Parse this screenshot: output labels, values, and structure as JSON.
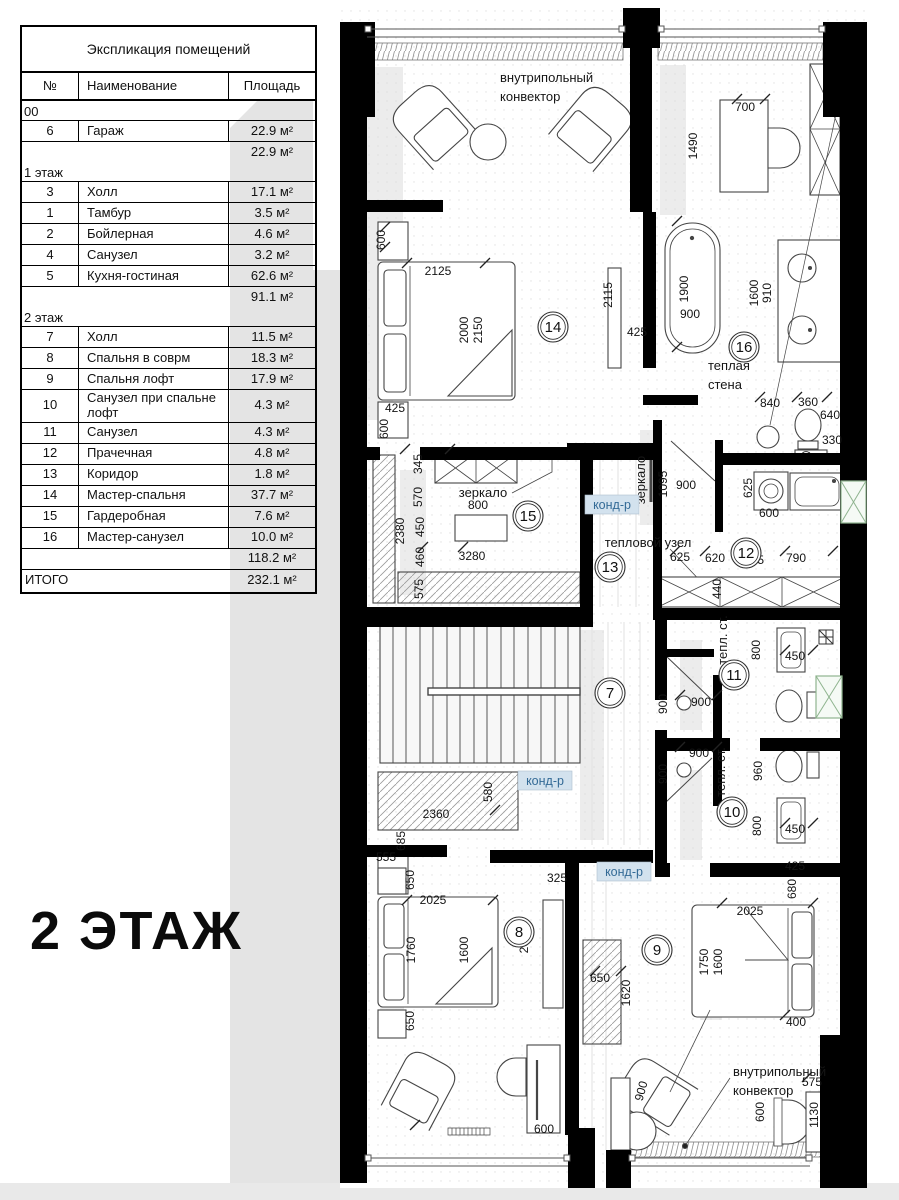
{
  "floor_title": "2 ЭТАЖ",
  "legend": {
    "title": "Экспликация помещений",
    "columns": [
      "№",
      "Наименование",
      "Площадь"
    ],
    "sections": [
      {
        "label": "00",
        "rows": [
          {
            "n": "6",
            "name": "Гараж",
            "area": "22.9 м²"
          }
        ],
        "subtotal": "22.9 м²"
      },
      {
        "label": "1 этаж",
        "rows": [
          {
            "n": "3",
            "name": "Холл",
            "area": "17.1 м²"
          },
          {
            "n": "1",
            "name": "Тамбур",
            "area": "3.5 м²"
          },
          {
            "n": "2",
            "name": "Бойлерная",
            "area": "4.6 м²"
          },
          {
            "n": "4",
            "name": "Санузел",
            "area": "3.2 м²"
          },
          {
            "n": "5",
            "name": "Кухня-гостиная",
            "area": "62.6 м²"
          }
        ],
        "subtotal": "91.1 м²"
      },
      {
        "label": "2 этаж",
        "rows": [
          {
            "n": "7",
            "name": "Холл",
            "area": "11.5 м²"
          },
          {
            "n": "8",
            "name": "Спальня в соврм",
            "area": "18.3 м²"
          },
          {
            "n": "9",
            "name": "Спальня лофт",
            "area": "17.9 м²"
          },
          {
            "n": "10",
            "name": "Санузел при спальне лофт",
            "area": "4.3 м²"
          },
          {
            "n": "11",
            "name": "Санузел",
            "area": "4.3 м²"
          },
          {
            "n": "12",
            "name": "Прачечная",
            "area": "4.8 м²"
          },
          {
            "n": "13",
            "name": "Коридор",
            "area": "1.8 м²"
          },
          {
            "n": "14",
            "name": "Мастер-спальня",
            "area": "37.7 м²"
          },
          {
            "n": "15",
            "name": "Гардеробная",
            "area": "7.6 м²"
          },
          {
            "n": "16",
            "name": "Мастер-санузел",
            "area": "10.0 м²"
          }
        ],
        "subtotal": "118.2 м²"
      }
    ],
    "total_label": "ИТОГО",
    "total": "232.1 м²"
  },
  "plan": {
    "rooms": [
      {
        "n": "14",
        "x": 213,
        "y": 327
      },
      {
        "n": "16",
        "x": 404,
        "y": 347
      },
      {
        "n": "15",
        "x": 188,
        "y": 516
      },
      {
        "n": "13",
        "x": 270,
        "y": 567
      },
      {
        "n": "12",
        "x": 406,
        "y": 553
      },
      {
        "n": "7",
        "x": 270,
        "y": 693
      },
      {
        "n": "11",
        "x": 394,
        "y": 675
      },
      {
        "n": "10",
        "x": 392,
        "y": 812
      },
      {
        "n": "8",
        "x": 179,
        "y": 932
      },
      {
        "n": "9",
        "x": 317,
        "y": 950
      }
    ],
    "tags": [
      {
        "t": "конд-р",
        "x": 272,
        "y": 505
      },
      {
        "t": "конд-р",
        "x": 205,
        "y": 781
      },
      {
        "t": "конд-р",
        "x": 284,
        "y": 872
      }
    ],
    "labels": [
      {
        "t": "внутрипольный",
        "x": 160,
        "y": 82,
        "a": "start"
      },
      {
        "t": "конвектор",
        "x": 160,
        "y": 101,
        "a": "start"
      },
      {
        "t": "теплая",
        "x": 368,
        "y": 370,
        "a": "start"
      },
      {
        "t": "стена",
        "x": 368,
        "y": 389,
        "a": "start"
      },
      {
        "t": "зеркало",
        "x": 143,
        "y": 497
      },
      {
        "t": "зеркало",
        "x": 305,
        "y": 480,
        "r": -90
      },
      {
        "t": "тепловой узел",
        "x": 308,
        "y": 547
      },
      {
        "t": "тепл. ст.",
        "x": 387,
        "y": 640,
        "r": -90,
        "s": 11
      },
      {
        "t": "тепл. ст.",
        "x": 385,
        "y": 772,
        "r": -90,
        "s": 11
      },
      {
        "t": "внутрипольный",
        "x": 393,
        "y": 1076,
        "a": "start"
      },
      {
        "t": "конвектор",
        "x": 393,
        "y": 1095,
        "a": "start"
      }
    ],
    "dims": [
      {
        "t": "700",
        "x": 405,
        "y": 111
      },
      {
        "t": "1490",
        "x": 357,
        "y": 146,
        "r": -90
      },
      {
        "t": "600",
        "x": 45,
        "y": 240,
        "r": -90
      },
      {
        "t": "2125",
        "x": 98,
        "y": 275
      },
      {
        "t": "2000",
        "x": 128,
        "y": 330,
        "r": -90
      },
      {
        "t": "2150",
        "x": 142,
        "y": 330,
        "r": -90
      },
      {
        "t": "2115",
        "x": 272,
        "y": 295,
        "r": -90
      },
      {
        "t": "425",
        "x": 297,
        "y": 336
      },
      {
        "t": "1900",
        "x": 348,
        "y": 289,
        "r": -90
      },
      {
        "t": "900",
        "x": 350,
        "y": 318
      },
      {
        "t": "1600",
        "x": 418,
        "y": 293,
        "r": -90
      },
      {
        "t": "910",
        "x": 431,
        "y": 293,
        "r": -90
      },
      {
        "t": "425",
        "x": 55,
        "y": 412
      },
      {
        "t": "600",
        "x": 48,
        "y": 429,
        "r": -90
      },
      {
        "t": "840",
        "x": 430,
        "y": 407
      },
      {
        "t": "360",
        "x": 468,
        "y": 406
      },
      {
        "t": "640",
        "x": 490,
        "y": 419
      },
      {
        "t": "330",
        "x": 492,
        "y": 444
      },
      {
        "t": "345",
        "x": 82,
        "y": 464,
        "r": -90
      },
      {
        "t": "570",
        "x": 82,
        "y": 497,
        "r": -90
      },
      {
        "t": "450",
        "x": 84,
        "y": 527,
        "r": -90
      },
      {
        "t": "460",
        "x": 84,
        "y": 557,
        "r": -90
      },
      {
        "t": "575",
        "x": 83,
        "y": 589,
        "r": -90
      },
      {
        "t": "2380",
        "x": 64,
        "y": 531,
        "r": -90
      },
      {
        "t": "800",
        "x": 138,
        "y": 509
      },
      {
        "t": "3280",
        "x": 132,
        "y": 560
      },
      {
        "t": "1095",
        "x": 327,
        "y": 484,
        "r": -90
      },
      {
        "t": "900",
        "x": 346,
        "y": 489
      },
      {
        "t": "625",
        "x": 412,
        "y": 488,
        "r": -90
      },
      {
        "t": "600",
        "x": 429,
        "y": 517
      },
      {
        "t": "625",
        "x": 340,
        "y": 561
      },
      {
        "t": "620",
        "x": 375,
        "y": 562
      },
      {
        "t": "625",
        "x": 414,
        "y": 564
      },
      {
        "t": "790",
        "x": 456,
        "y": 562
      },
      {
        "t": "440",
        "x": 381,
        "y": 589,
        "r": -90
      },
      {
        "t": "900",
        "x": 361,
        "y": 706
      },
      {
        "t": "900",
        "x": 327,
        "y": 704,
        "r": -90
      },
      {
        "t": "800",
        "x": 420,
        "y": 650,
        "r": -90
      },
      {
        "t": "450",
        "x": 455,
        "y": 660
      },
      {
        "t": "900",
        "x": 359,
        "y": 757
      },
      {
        "t": "900",
        "x": 327,
        "y": 774,
        "r": -90
      },
      {
        "t": "960",
        "x": 422,
        "y": 771,
        "r": -90
      },
      {
        "t": "800",
        "x": 421,
        "y": 826,
        "r": -90
      },
      {
        "t": "450",
        "x": 455,
        "y": 833
      },
      {
        "t": "580",
        "x": 152,
        "y": 792,
        "r": -90
      },
      {
        "t": "2360",
        "x": 96,
        "y": 818
      },
      {
        "t": "685",
        "x": 65,
        "y": 841,
        "r": -90
      },
      {
        "t": "555",
        "x": 46,
        "y": 861
      },
      {
        "t": "650",
        "x": 74,
        "y": 880,
        "r": -90
      },
      {
        "t": "2025",
        "x": 93,
        "y": 904
      },
      {
        "t": "1760",
        "x": 75,
        "y": 950,
        "r": -90
      },
      {
        "t": "1600",
        "x": 128,
        "y": 950,
        "r": -90
      },
      {
        "t": "2055",
        "x": 188,
        "y": 940,
        "r": -90
      },
      {
        "t": "325",
        "x": 217,
        "y": 882
      },
      {
        "t": "650",
        "x": 74,
        "y": 1021,
        "r": -90
      },
      {
        "t": "600",
        "x": 204,
        "y": 1133
      },
      {
        "t": "425",
        "x": 455,
        "y": 870
      },
      {
        "t": "680",
        "x": 456,
        "y": 889,
        "r": -90
      },
      {
        "t": "2025",
        "x": 410,
        "y": 915
      },
      {
        "t": "1750",
        "x": 368,
        "y": 962,
        "r": -90
      },
      {
        "t": "1600",
        "x": 382,
        "y": 962,
        "r": -90
      },
      {
        "t": "650",
        "x": 260,
        "y": 982
      },
      {
        "t": "1620",
        "x": 290,
        "y": 993,
        "r": -90
      },
      {
        "t": "400",
        "x": 456,
        "y": 1026
      },
      {
        "t": "900",
        "x": 305,
        "y": 1092,
        "r": -75
      },
      {
        "t": "600",
        "x": 424,
        "y": 1112,
        "r": -90
      },
      {
        "t": "575",
        "x": 472,
        "y": 1086
      },
      {
        "t": "1130",
        "x": 478,
        "y": 1115,
        "r": -90
      }
    ],
    "colors": {
      "wall": "#000000",
      "line": "#3f3f3f",
      "tag_bg": "#d3e2ee",
      "tag_text": "#336a96",
      "vent_stroke": "#8fb48f",
      "shadow": "#dadada",
      "page_strip": "#e9e9e9"
    }
  }
}
